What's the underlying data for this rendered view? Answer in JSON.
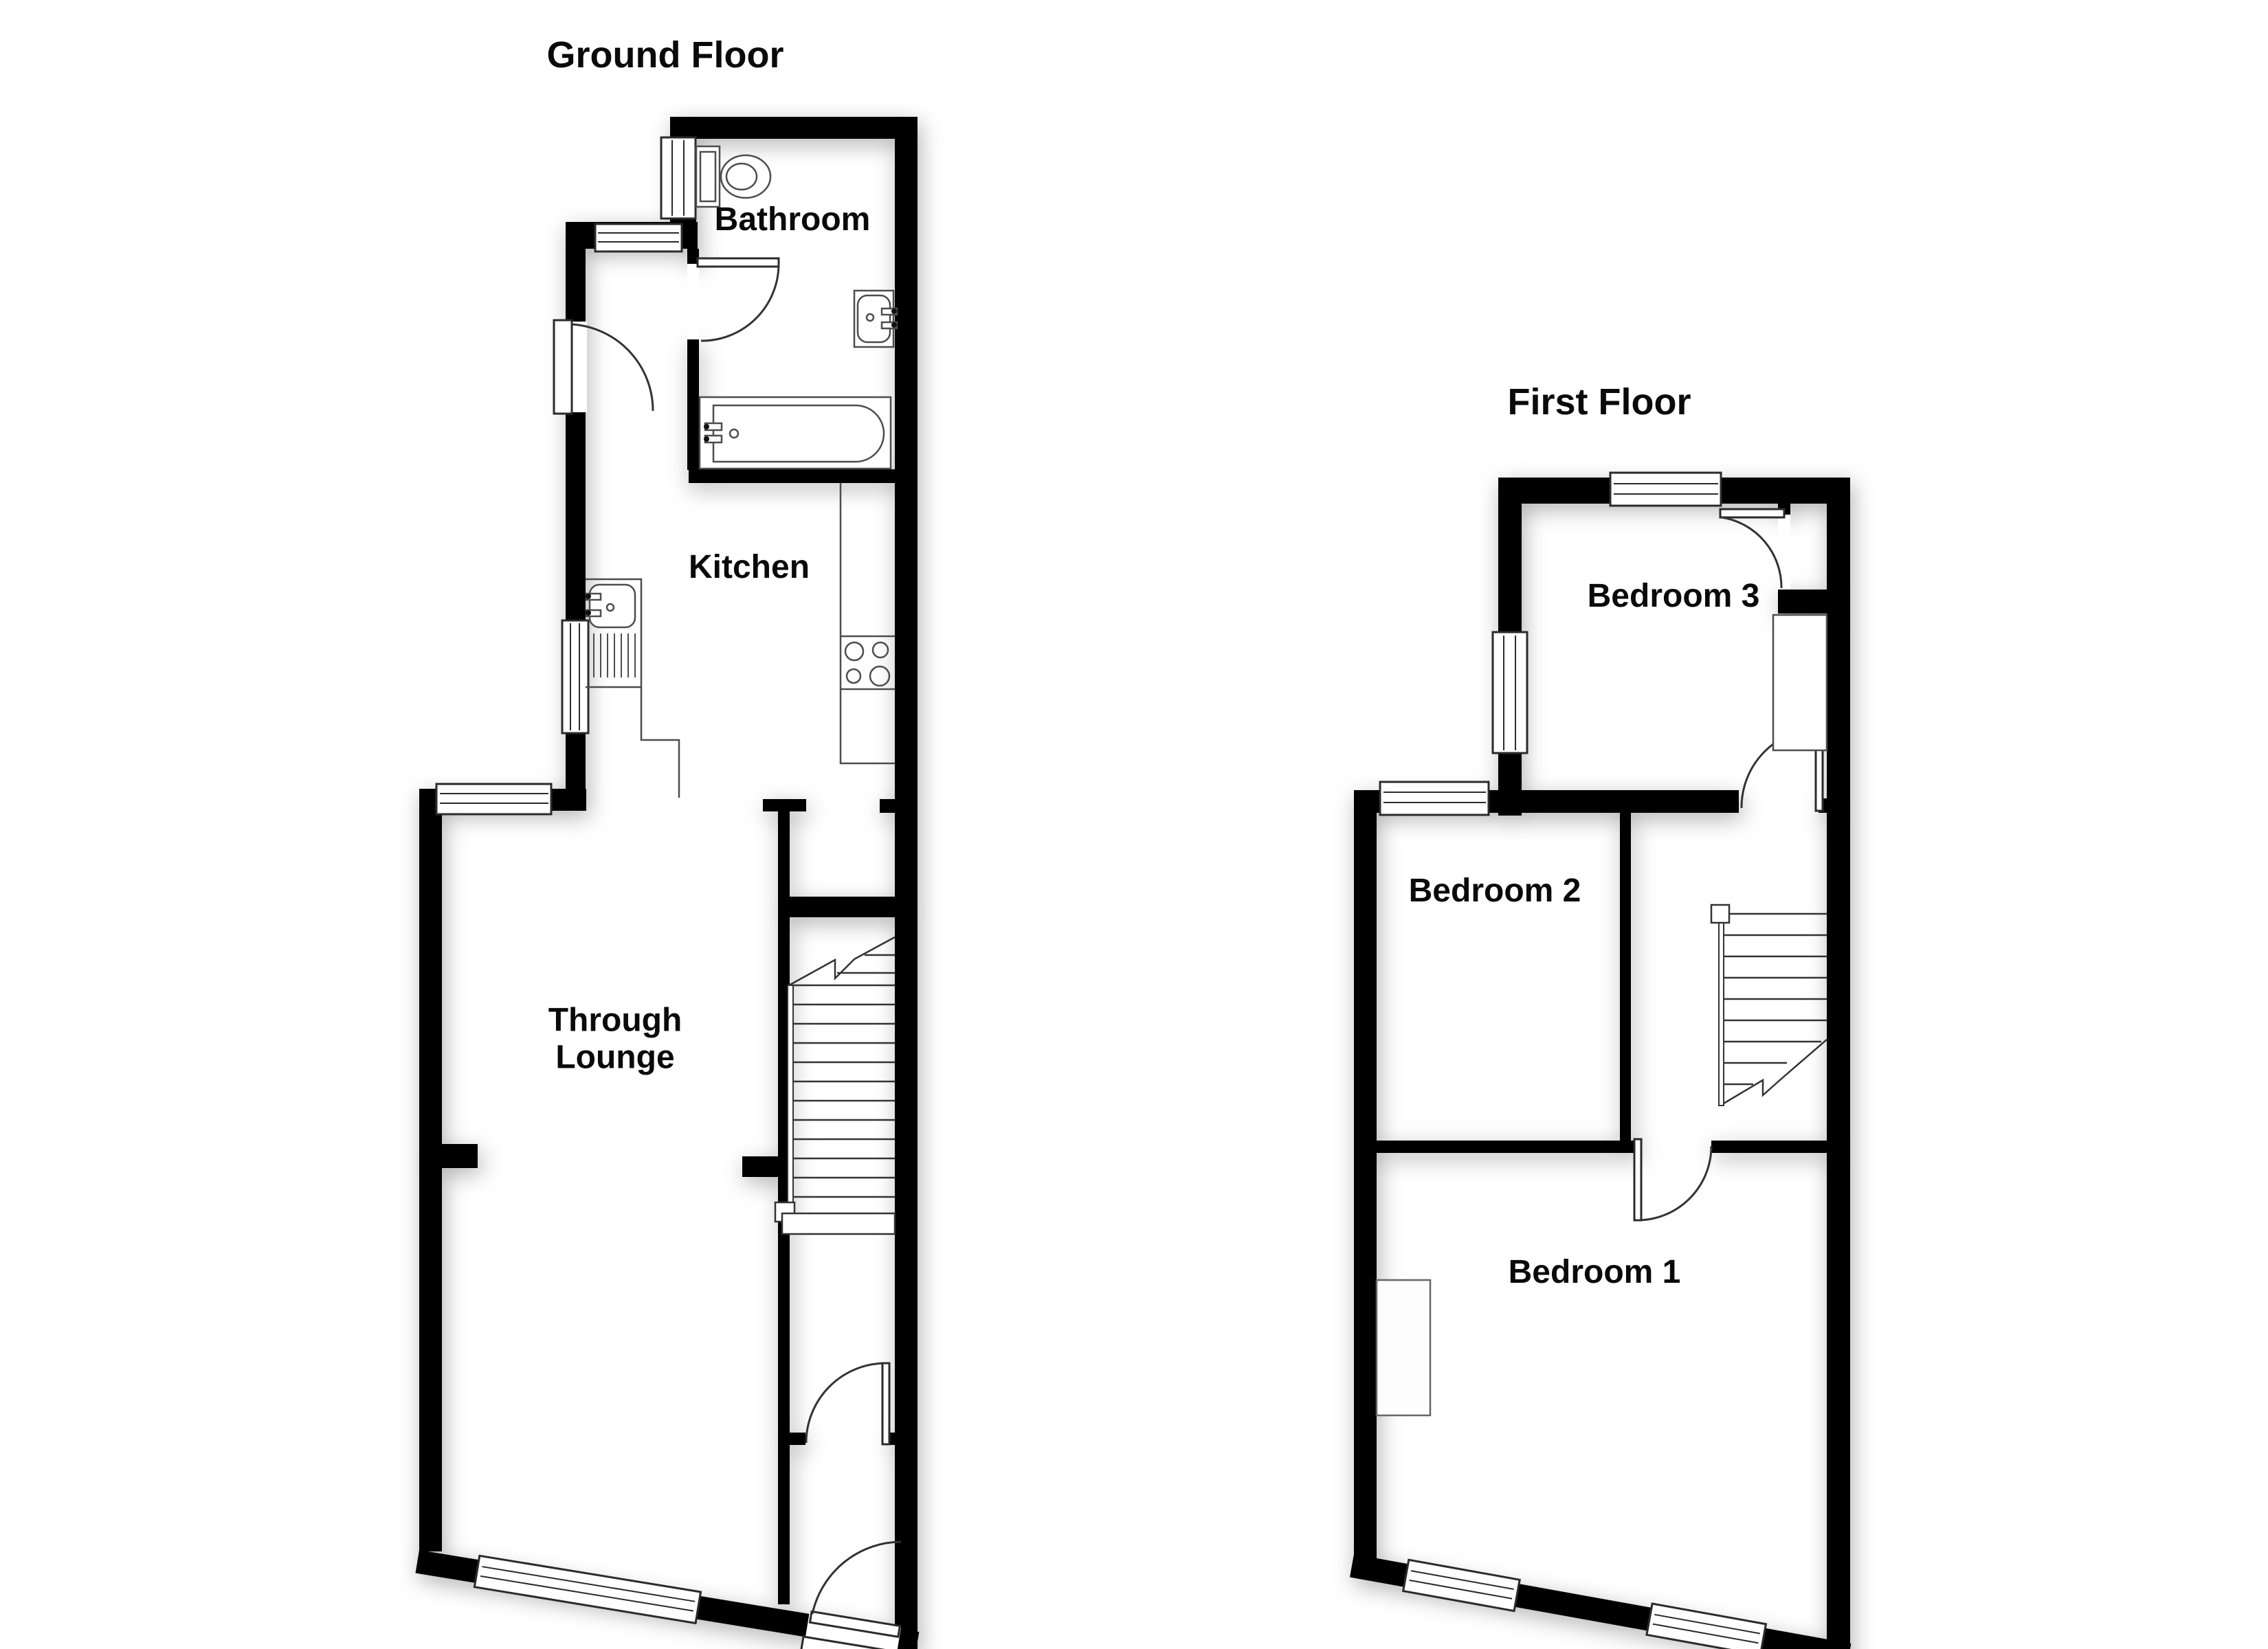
{
  "document": {
    "type": "estate-agent floor plan",
    "floor_count": 2
  },
  "titles": {
    "ground": "Ground Floor",
    "first": "First Floor"
  },
  "rooms": {
    "bathroom": "Bathroom",
    "kitchen": "Kitchen",
    "lounge": "Through Lounge",
    "bedroom3": "Bedroom 3",
    "bedroom2": "Bedroom 2",
    "bedroom1": "Bedroom 1"
  },
  "colors": {
    "wall": "#000000",
    "bg": "#ffffff",
    "line": "#3d3d3d",
    "fixture": "#4d4d4d",
    "text": "#0a0a0a"
  },
  "fixtures": {
    "ground_floor": [
      "window",
      "entry-door",
      "bathroom-door",
      "toilet",
      "wash-basin",
      "bath",
      "kitchen-sink-drainer",
      "hob-4-burner",
      "kitchen-counter",
      "staircase-up",
      "hall-door",
      "front-door"
    ],
    "first_floor": [
      "window",
      "bedroom3-door",
      "landing-door",
      "bedroom1-door",
      "cupboard",
      "wardrobe",
      "staircase-down"
    ]
  }
}
